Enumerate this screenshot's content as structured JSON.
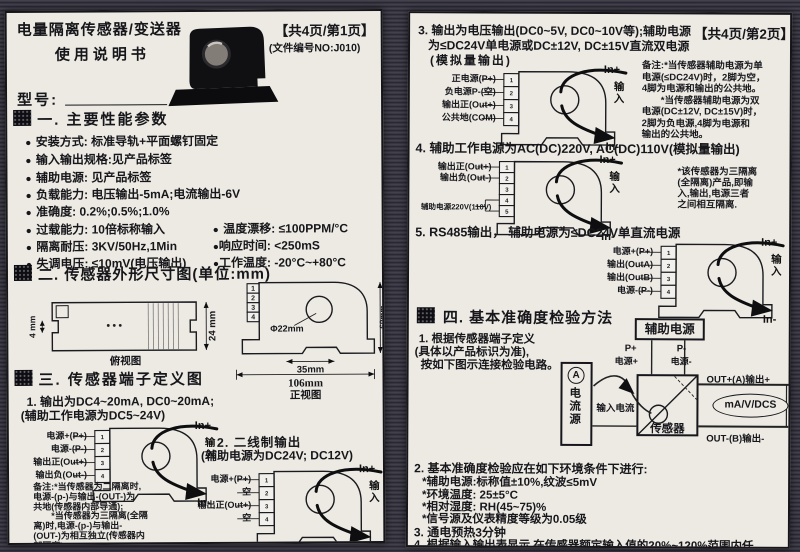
{
  "shared": {
    "bullet": "●",
    "pins": [
      "1",
      "2",
      "3",
      "4",
      "5"
    ],
    "io": {
      "in_plus": "In+",
      "input": "输入",
      "in_minus": "In-"
    }
  },
  "page1": {
    "title1": "电量隔离传感器/变送器",
    "title2": "使用说明书",
    "page_info": "【共4页/第1页】",
    "doc_no": "(文件编号NO:J010)",
    "model_label": "型号:",
    "sec1": "一. 主要性能参数",
    "params": [
      "安装方式: 标准导轨+平面螺钉固定",
      "输入输出规格:见产品标签",
      "辅助电源: 见产品标签",
      "负载能力: 电压输出-5mA;电流输出-6V",
      "准确度: 0.2%;0.5%;1.0%",
      "过载能力: 10倍标称输入",
      "隔离耐压: 3KV/50Hz,1Min",
      "失调电压: ≤10mV(电压输出)"
    ],
    "params_right": [
      "温度漂移: ≤100PPM/°C",
      "响应时间: <250mS",
      "工作温度: -20°C~+80°C"
    ],
    "sec2": "二. 传感器外形尺寸图(单位:mm)",
    "dims": {
      "d4mm": "4 mm",
      "d24mm": "24 mm",
      "top_caption": "俯视图",
      "dia": "Φ22mm",
      "d35": "35mm",
      "d106": "106mm",
      "d60": "60mm",
      "front_caption": "正视图"
    },
    "sec3": "三. 传感器端子定义图",
    "item1_line1": "1. 输出为DC4~20mA, DC0~20mA;",
    "item1_line2": "(辅助工作电源为DC5~24V)",
    "d1_terminals": [
      "电源+(P+)",
      "电源-(P-)",
      "输出正(Out+)",
      "输出负(Out-)"
    ],
    "note1": [
      "备注:*当传感器为二隔离时,",
      "电源-(p-)与输出-(OUT-)为",
      "共地(传感器内部导通);",
      "　　*当传感器为三隔离(全隔",
      "离)时,电源-(p-)与输出-",
      "(OUT-)为相互独立(传感器内",
      "部隔离)"
    ],
    "item2_line1": "2. 二线制输出",
    "item2_line2": "(辅助电源为DC24V; DC12V)",
    "d2_terminals": [
      "电源+(P+)",
      "空",
      "输出正(Out+)",
      "空"
    ]
  },
  "page2": {
    "page_info": "【共4页/第2页】",
    "item3_line1": "3. 输出为电压输出(DC0~5V, DC0~10V等);辅助电源",
    "item3_line2": "为≤DC24V单电源或DC±12V, DC±15V直流双电源",
    "item3_line3": "(模拟量输出)",
    "d3_terminals": [
      "正电源(P+)",
      "负电源P-(空)",
      "输出正(Out+)",
      "公共地(COM)"
    ],
    "note3": [
      "备注:*当传感器辅助电源为单",
      "电源(≤DC24V)时，2脚为空，",
      "4脚为电源和输出的公共地。",
      "　　*当传感器辅助电源为双",
      "电源(DC±12V, DC±15V)时，",
      "2脚为负电源,4脚为电源和",
      "输出的公共地。"
    ],
    "item4_title": "4. 辅助工作电源为AC(DC)220V, AC(DC)110V(模拟量输出)",
    "d4_terminals": [
      "输出正(Out+)",
      "输出负(Out-)",
      "辅助电源220V(110V)"
    ],
    "note4": [
      "*该传感器为三隔离",
      "(全隔离)产品,即输",
      "入,输出,电源三者",
      "之间相互隔离."
    ],
    "item5_title": "5. RS485输出， 辅助电源为≤DC24V单直流电源",
    "d5_terminals": [
      "电源+(P+)",
      "输出(OutA)",
      "输出(OutB)",
      "电源-(P-)"
    ],
    "sec4": "四. 基本准确度检验方法",
    "s1_lines": [
      "1. 根据传感器端子定义",
      "(具体以产品标识为准),",
      "按如下图示连接检验电路。"
    ],
    "check": {
      "aux": "辅助电源",
      "p_plus": "P+",
      "p_plus_cn": "电源+",
      "p_minus": "P-",
      "p_minus_cn": "电源-",
      "ammeter": "A",
      "source": "电流源",
      "input_current": "输入电流",
      "sensor": "传感器",
      "out_a": "OUT+(A)输出+",
      "meter": "mA/V/DCS",
      "out_b": "OUT-(B)输出-"
    },
    "s2_title": "2. 基本准确度检验应在如下环境条件下进行:",
    "s2_items": [
      "*辅助电源:标称值±10%,纹波≤5mV",
      "*环境温度: 25±5°C",
      "*相对湿度: RH(45~75)%",
      "*信号源及仪表精度等级为0.05级"
    ],
    "s3": "3. 通电预热3分钟",
    "s4_line1": "4. 根据输入输出表显示,在传感器额定输入值的20%~120%范围内任",
    "s4_line2": "意给定输入值， 记录对应的输出值。"
  }
}
